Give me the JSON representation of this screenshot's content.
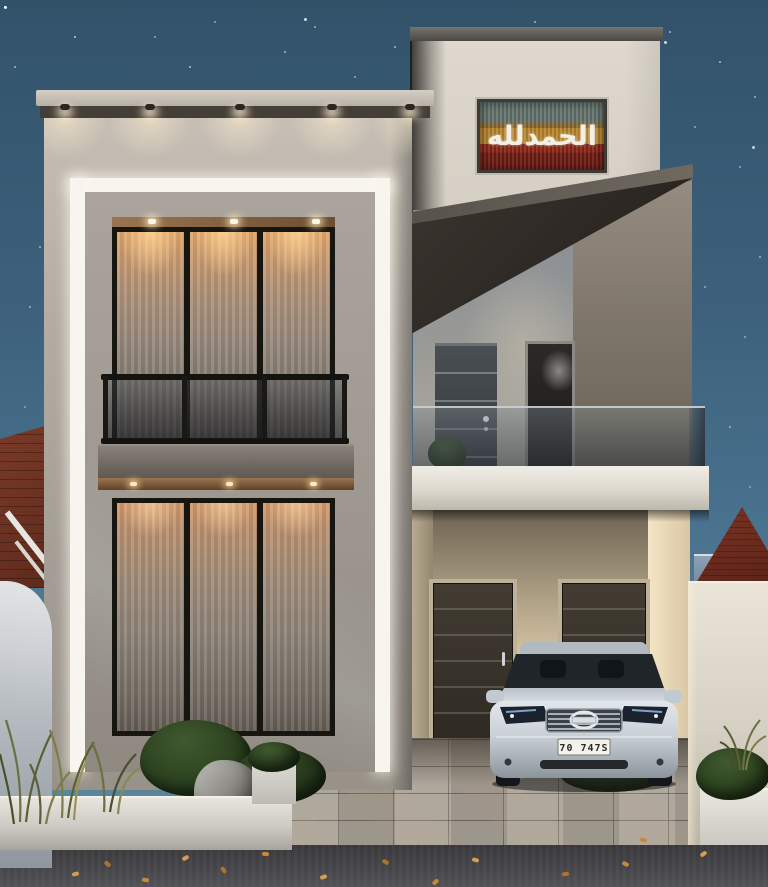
{
  "scene": {
    "calligraphy": {
      "text": "الحمدلله",
      "script_color": "#f2efe6",
      "panel_teal": "#66756f",
      "panel_gold": "#b8862e",
      "panel_red": "#8c2718"
    },
    "car": {
      "license_plate": "70 747S",
      "body_color": "#c9d0d6",
      "plate_bg": "#f4f2ea"
    },
    "colors": {
      "sky_top": "#32526a",
      "sky_bottom": "#5d89a0",
      "facade_wall": "#b2aca3",
      "tower_wall": "#ddd8cf",
      "led_frame": "#f8f5ef",
      "curtain_glow": "#e0a266",
      "canopy_dark": "#3a352f",
      "side_volume": "#8a8177",
      "entry_door": "#3a352e",
      "carport_wall": "#d7c6a6",
      "glass_railing": "#3a4248",
      "left_roof": "#703324",
      "right_roof": "#6e2f23",
      "right_siding": "#7d95a8",
      "paver": "#a9a196",
      "asphalt": "#3e3d40",
      "foliage": "#2c4220",
      "leaf_orange": "#c8893b"
    }
  }
}
